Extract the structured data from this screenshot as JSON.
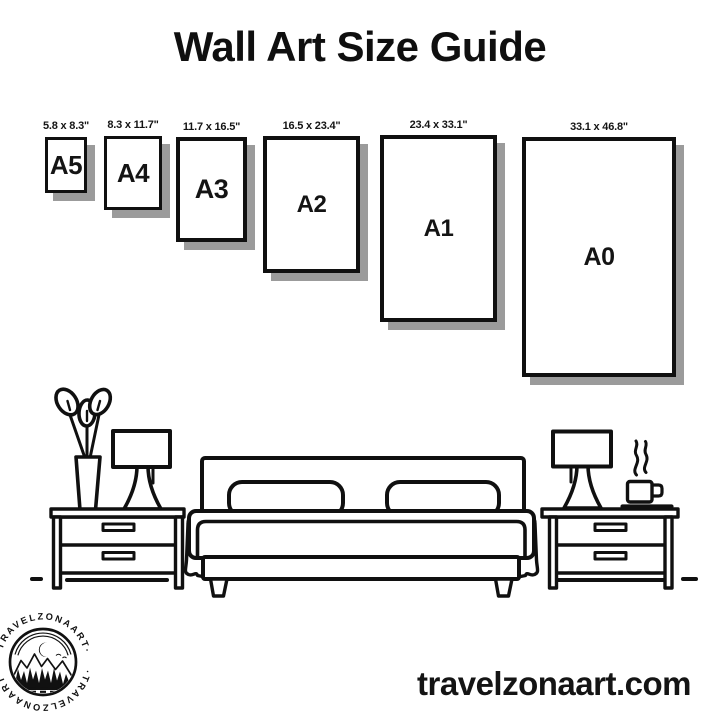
{
  "title": "Wall Art Size Guide",
  "frames": [
    {
      "name": "A5",
      "size": "5.8 x 8.3\""
    },
    {
      "name": "A4",
      "size": "8.3 x 11.7\""
    },
    {
      "name": "A3",
      "size": "11.7 x 16.5\""
    },
    {
      "name": "A2",
      "size": "16.5 x 23.4\""
    },
    {
      "name": "A1",
      "size": "23.4 x 33.1\""
    },
    {
      "name": "A0",
      "size": "33.1 x 46.8\""
    }
  ],
  "logo": {
    "brand_top": "·TRAVELZONAART·",
    "brand_bottom": "·TRAVELZONAART·"
  },
  "website": "travelzonaart.com",
  "icons": {
    "flower-vase": "vase with three leaves",
    "table-lamp-left": "table lamp with rectangular shade",
    "table-lamp-right": "table lamp with rectangular shade",
    "nightstand-left": "two-drawer nightstand",
    "nightstand-right": "two-drawer nightstand",
    "bed": "double bed with headboard and two pillows",
    "coffee-cup": "steaming coffee cup on saucer",
    "logo-badge": "circular badge with moon, mountains, trees and lake"
  },
  "colors": {
    "ink": "#101010",
    "frame_shadow": "#9b9b9b",
    "background": "#ffffff"
  }
}
